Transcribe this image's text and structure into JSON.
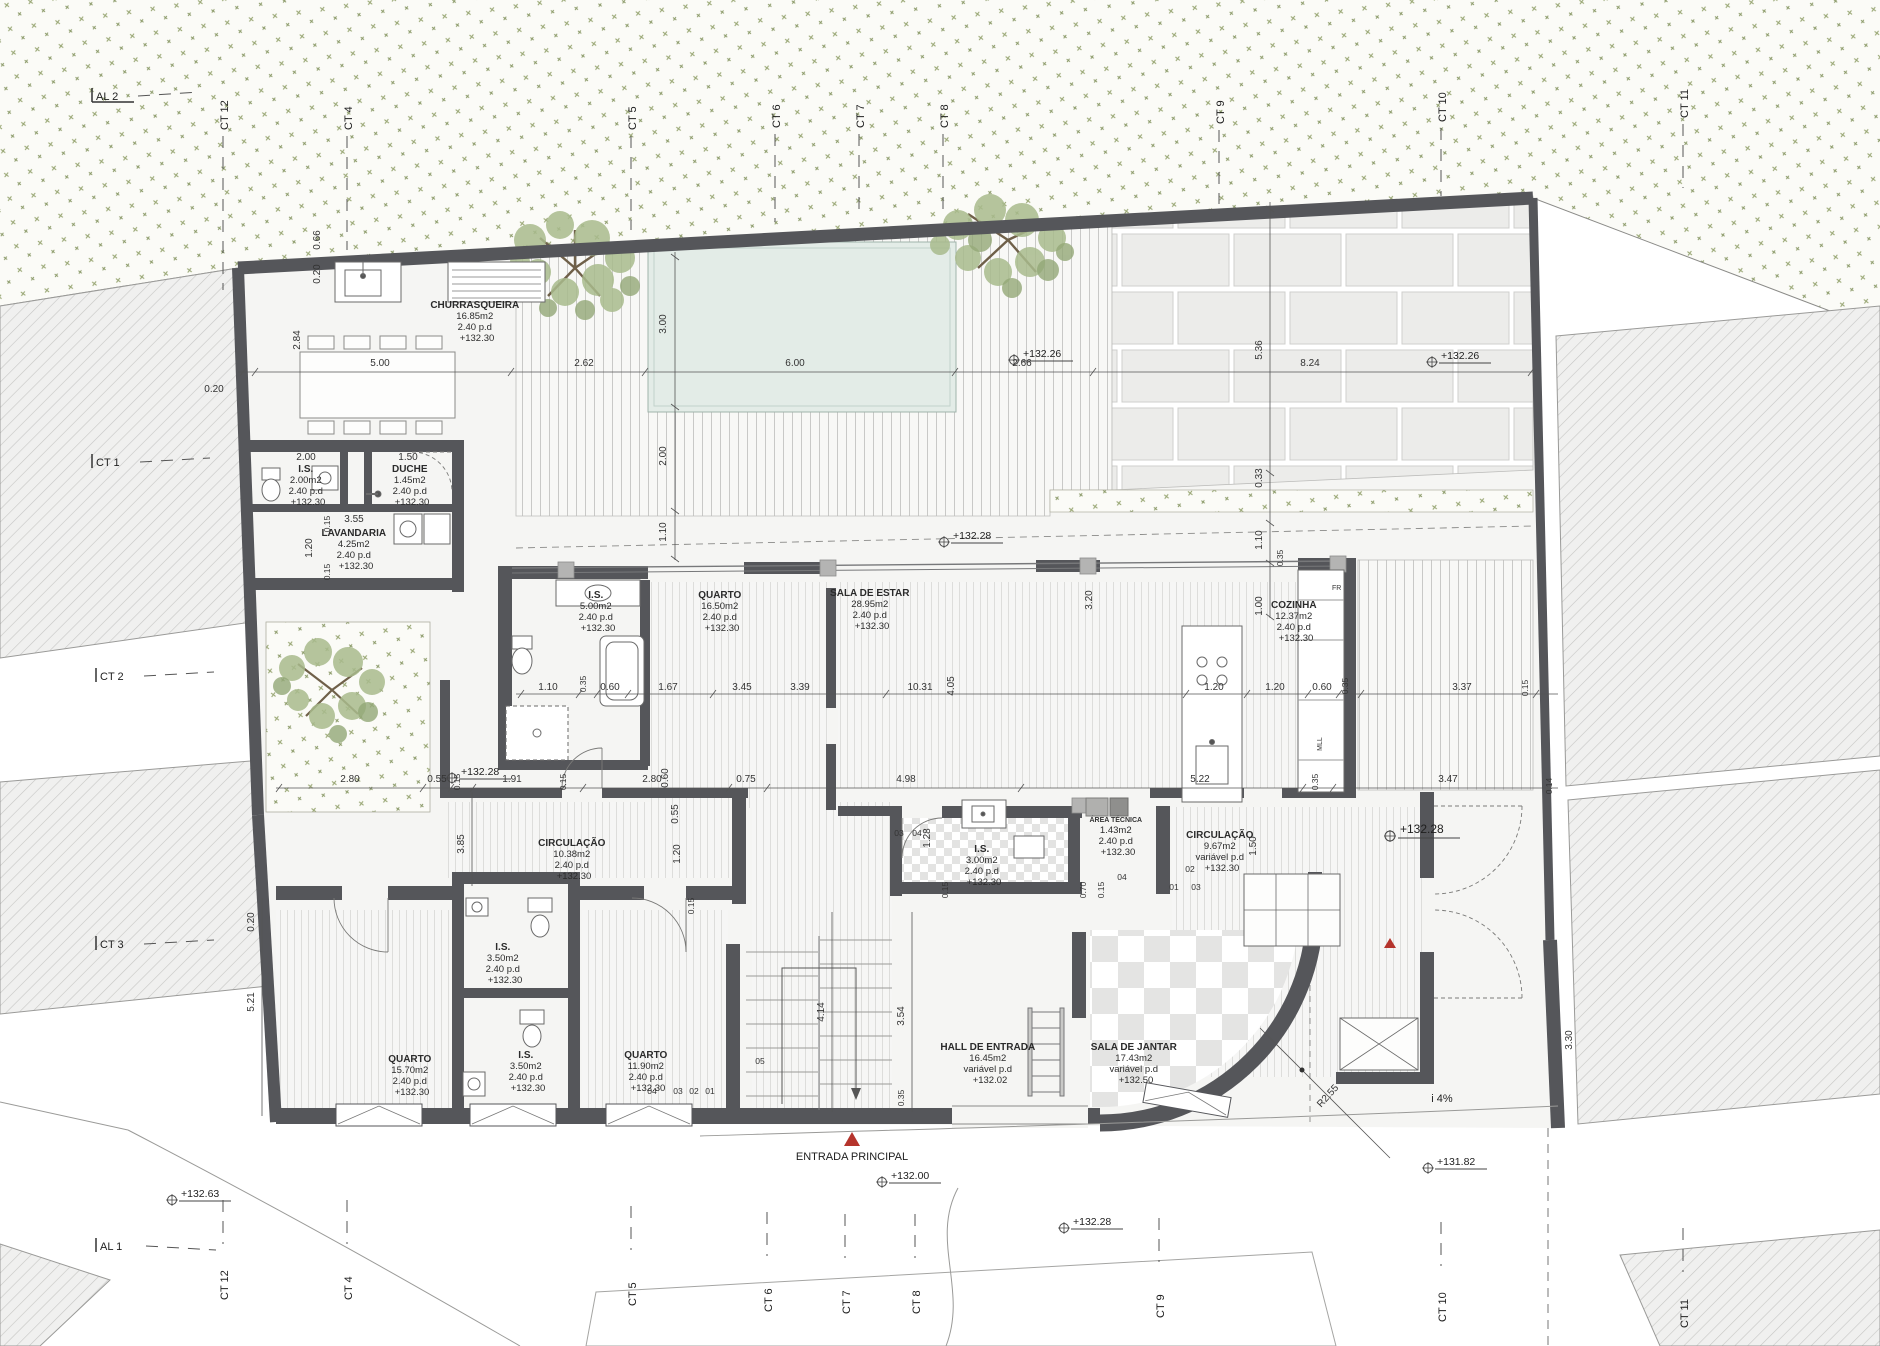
{
  "drawing": {
    "type": "architectural floor plan",
    "language": "pt"
  },
  "colors": {
    "wall": "#55565a",
    "pool": "#e3ece7",
    "vegetation": "#a9bb8d",
    "entrance_marker": "#b5342c",
    "hatch_line": "#c6c6c4",
    "paper": "#ffffff"
  },
  "rooms": [
    {
      "name": "CHURRASQUEIRA",
      "area": "16.85m2",
      "pd": "2.40  p.d",
      "level": "+132.30"
    },
    {
      "name": "I.S.",
      "area": "2.00m2",
      "pd": "2.40  p.d",
      "level": "+132.30"
    },
    {
      "name": "DUCHE",
      "area": "1.45m2",
      "pd": "2.40  p.d",
      "level": "+132.30"
    },
    {
      "name": "LAVANDARIA",
      "area": "4.25m2",
      "pd": "2.40  p.d",
      "level": "+132.30"
    },
    {
      "name": "I.S.",
      "area": "5.00m2",
      "pd": "2.40  p.d",
      "level": "+132.30"
    },
    {
      "name": "QUARTO",
      "area": "16.50m2",
      "pd": "2.40  p.d",
      "level": "+132.30"
    },
    {
      "name": "SALA DE ESTAR",
      "area": "28.95m2",
      "pd": "2.40  p.d",
      "level": "+132.30"
    },
    {
      "name": "COZINHA",
      "area": "12.37m2",
      "pd": "2.40  p.d",
      "level": "+132.30"
    },
    {
      "name": "CIRCULAÇÃO",
      "area": "10.38m2",
      "pd": "2.40  p.d",
      "level": "+132.30"
    },
    {
      "name": "I.S.",
      "area": "3.00m2",
      "pd": "2.40  p.d",
      "level": "+132.30"
    },
    {
      "name": "ÁREA TÉCNICA",
      "area": "1.43m2",
      "pd": "2.40  p.d",
      "level": "+132.30"
    },
    {
      "name": "CIRCULAÇÃO",
      "area": "9.67m2",
      "pd": "variável  p.d",
      "level": "+132.30"
    },
    {
      "name": "QUARTO",
      "area": "15.70m2",
      "pd": "2.40  p.d",
      "level": "+132.30"
    },
    {
      "name": "I.S.",
      "area": "3.50m2",
      "pd": "2.40  p.d",
      "level": "+132.30"
    },
    {
      "name": "I.S.",
      "area": "3.50m2",
      "pd": "2.40  p.d",
      "level": "+132.30"
    },
    {
      "name": "QUARTO",
      "area": "11.90m2",
      "pd": "2.40  p.d",
      "level": "+132.30"
    },
    {
      "name": "HALL DE ENTRADA",
      "area": "16.45m2",
      "pd": "variável  p.d",
      "level": "+132.02"
    },
    {
      "name": "SALA DE JANTAR",
      "area": "17.43m2",
      "pd": "variável  p.d",
      "level": "+132.50"
    }
  ],
  "grid": {
    "top": [
      "AL 2",
      "CT 12",
      "CT 4",
      "CT 5",
      "CT 6",
      "CT 7",
      "CT 8",
      "CT 9",
      "CT 10",
      "CT 11"
    ],
    "left": [
      "CT 1",
      "CT 2",
      "CT 3"
    ],
    "bottom": [
      "AL 1",
      "CT 12",
      "CT 4",
      "CT 5",
      "CT 6",
      "CT 7",
      "CT 8",
      "CT 9",
      "CT 10",
      "CT 11"
    ]
  },
  "elevations": [
    "+132.26",
    "+132.26",
    "+132.28",
    "+132.28",
    "+132.28",
    "+132.00",
    "+132.28",
    "+131.82",
    "+132.63"
  ],
  "dims": {
    "top": [
      "0.20",
      "5.00",
      "2.62",
      "6.00",
      "2.66",
      "8.24"
    ],
    "tv": [
      "0.66",
      "0.20",
      "2.84",
      "3.00",
      "2.00",
      "1.10",
      "5.36",
      "0.33",
      "1.10",
      "0.35",
      "1.00"
    ],
    "mid": [
      "1.10",
      "0.35",
      "0.60",
      "1.67",
      "3.45",
      "3.39",
      "10.31",
      "4.05",
      "1.20",
      "1.20",
      "0.60",
      "0.35",
      "3.37",
      "0.15"
    ],
    "mv": [
      "3.20",
      "0.60",
      "0.55",
      "1.20",
      "0.15",
      "1.50",
      "1.28",
      "0.70",
      "0.15",
      "0.15"
    ],
    "lb": [
      "2.00",
      "1.50",
      "0.15",
      "3.55",
      "1.20",
      "0.15"
    ],
    "low": [
      "2.80",
      "0.55",
      "0.15",
      "1.91",
      "0.15",
      "2.80",
      "0.75",
      "4.98",
      "5.22",
      "0.35",
      "3.47",
      "0.14"
    ],
    "lv": [
      "0.20",
      "5.21",
      "3.85",
      "4.14",
      "3.54",
      "0.35",
      "3.30"
    ]
  },
  "stair_marks": [
    "03",
    "04",
    "02",
    "01",
    "03",
    "04",
    "05",
    "04",
    "03",
    "02",
    "01"
  ],
  "annotations": {
    "entrance": "ENTRADA  PRINCIPAL",
    "slope": "i  4%",
    "radius": "R2.55",
    "fr": "FR",
    "mll": "MLL"
  }
}
